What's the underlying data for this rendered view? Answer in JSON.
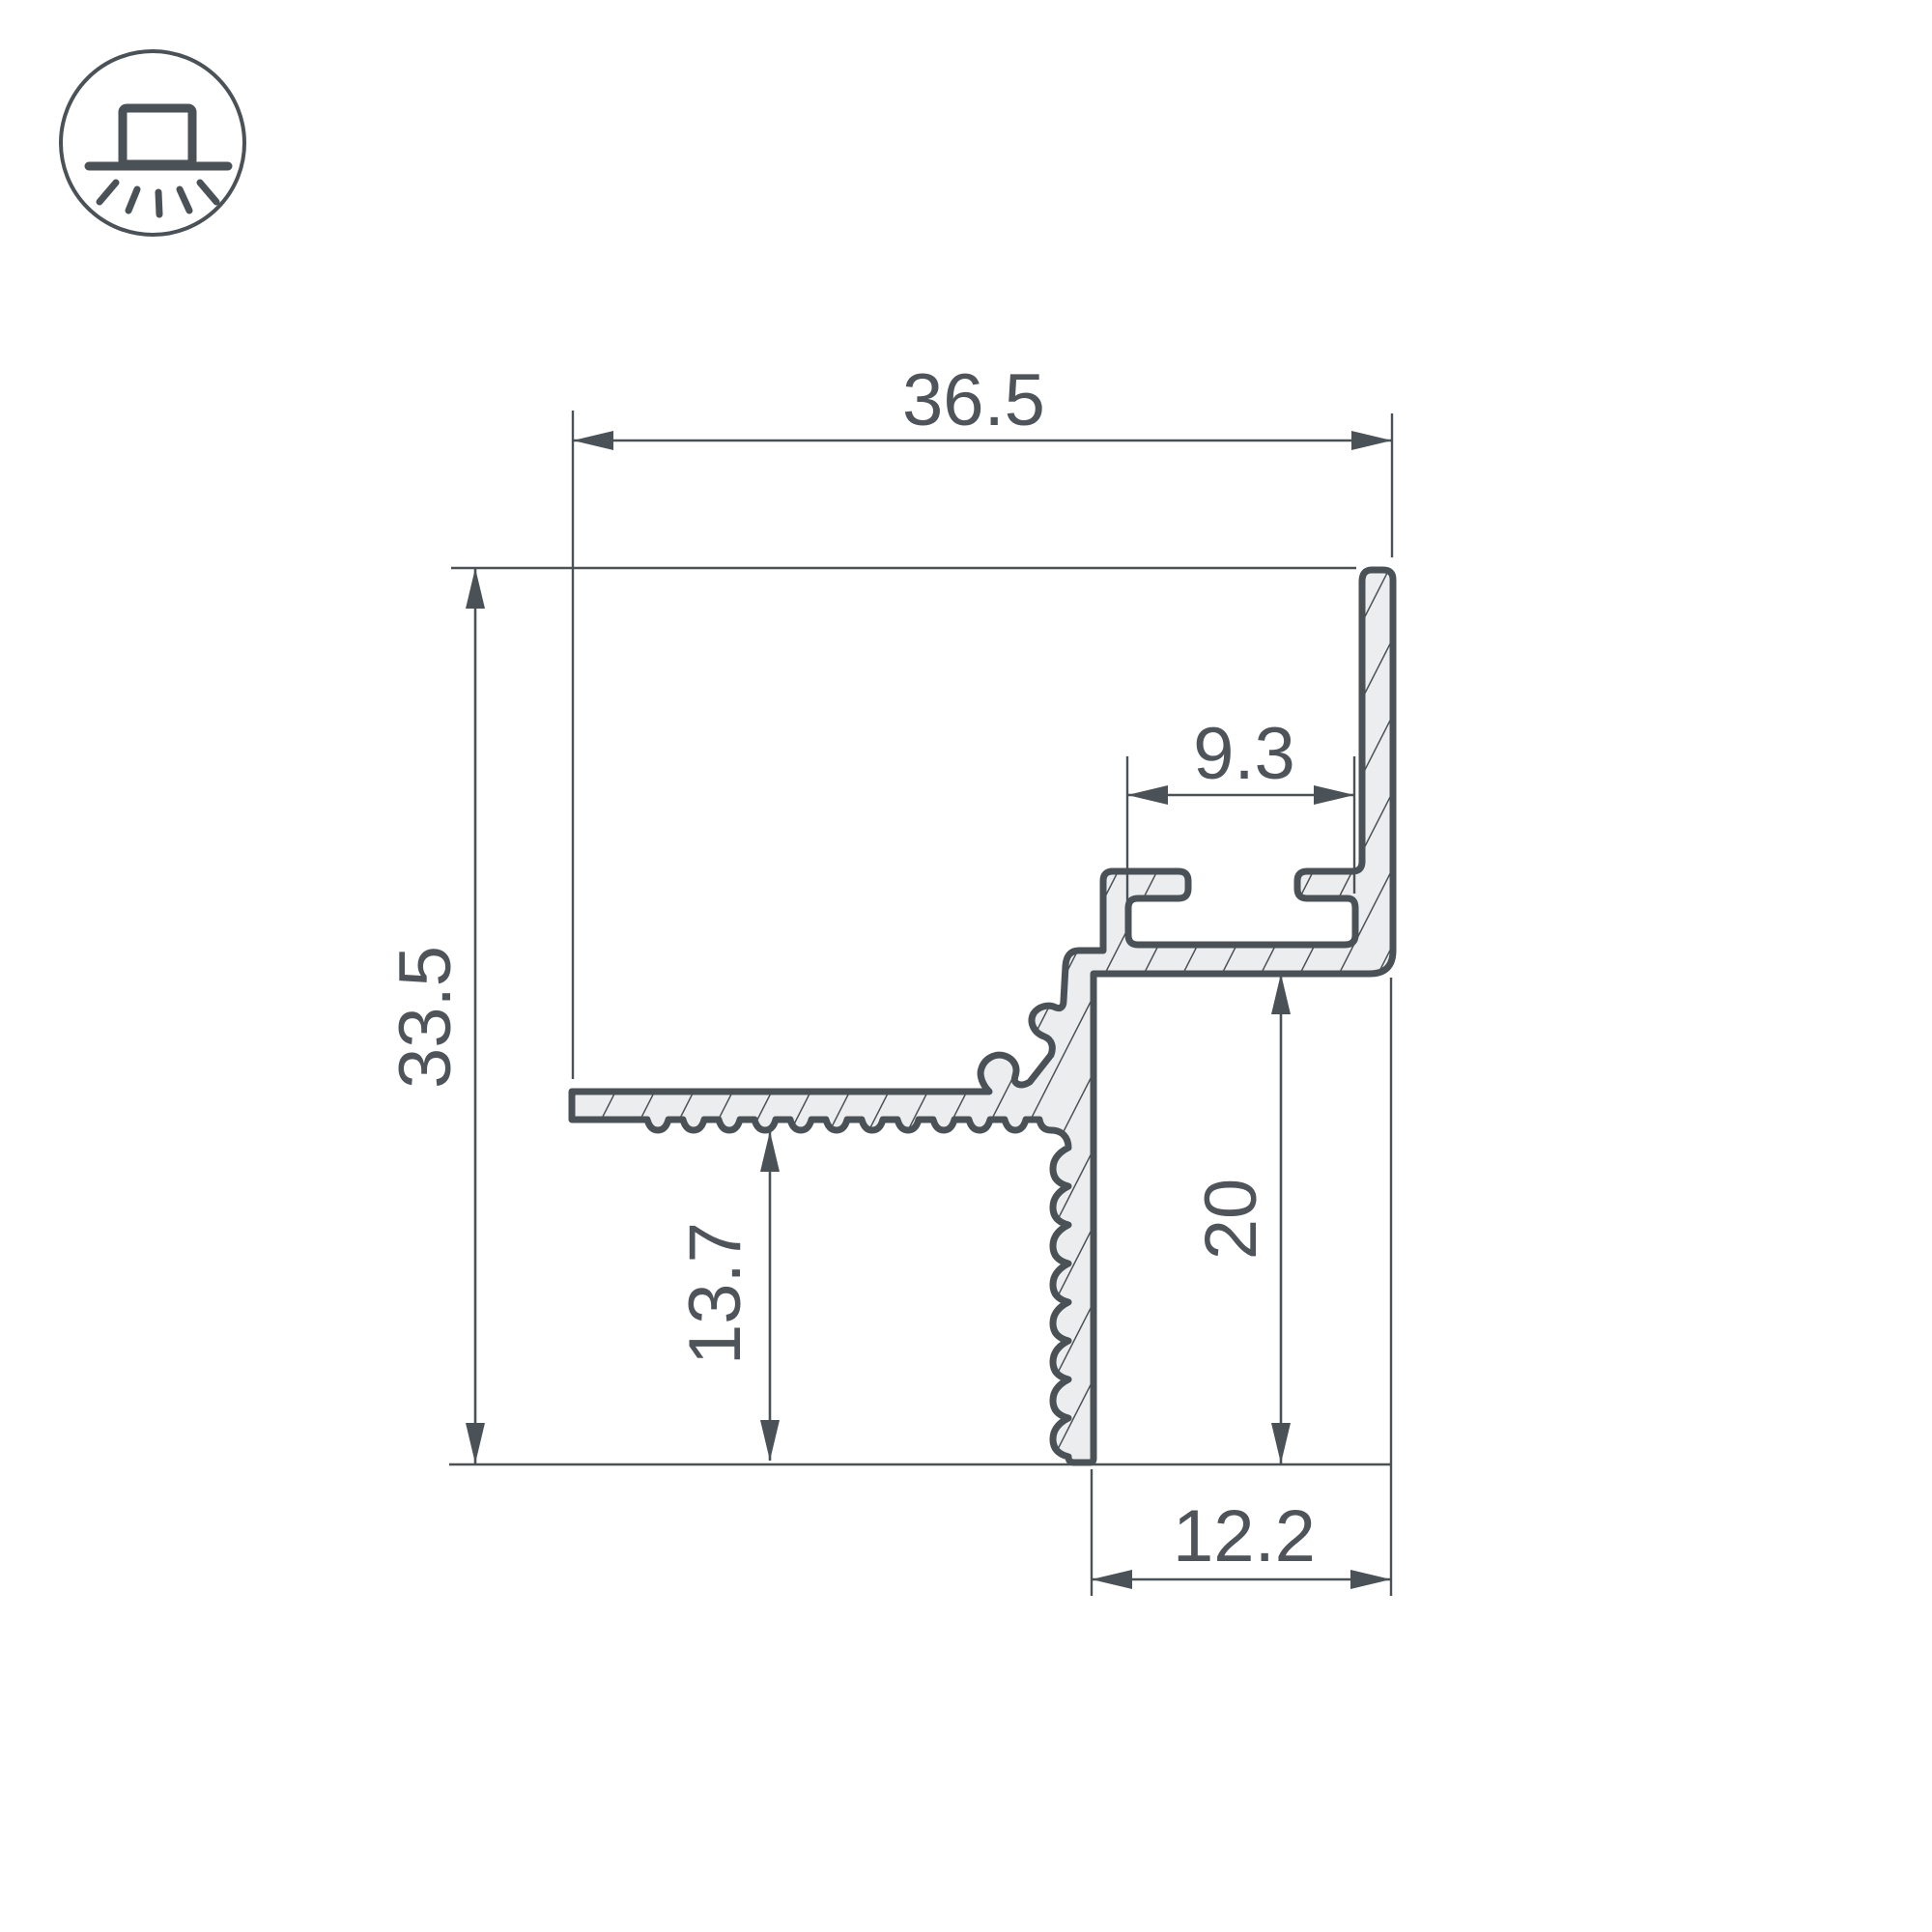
{
  "drawing": {
    "title": "LED profile cross-section technical drawing",
    "type": "profile-cross-section",
    "units": "mm",
    "dimensions": {
      "top_width": "36.5",
      "overall_height": "33.5",
      "slot_width": "9.3",
      "right_depth": "20",
      "flange_height": "13.7",
      "bottom_width": "12.2"
    }
  },
  "icon": {
    "name": "recessed-ceiling-light-icon",
    "description": "square luminaire on ceiling line with downward light rays inside a circle"
  },
  "colors": {
    "line": "#4b5257",
    "fill": "#ecedee",
    "text": "#4e545a",
    "background": "#ffffff"
  },
  "chart_data": {
    "type": "table",
    "title": "Profile dimensions (mm)",
    "categories": [
      "top width",
      "overall height",
      "slot width",
      "right depth",
      "flange height",
      "bottom width"
    ],
    "values": [
      36.5,
      33.5,
      9.3,
      20,
      13.7,
      12.2
    ]
  }
}
